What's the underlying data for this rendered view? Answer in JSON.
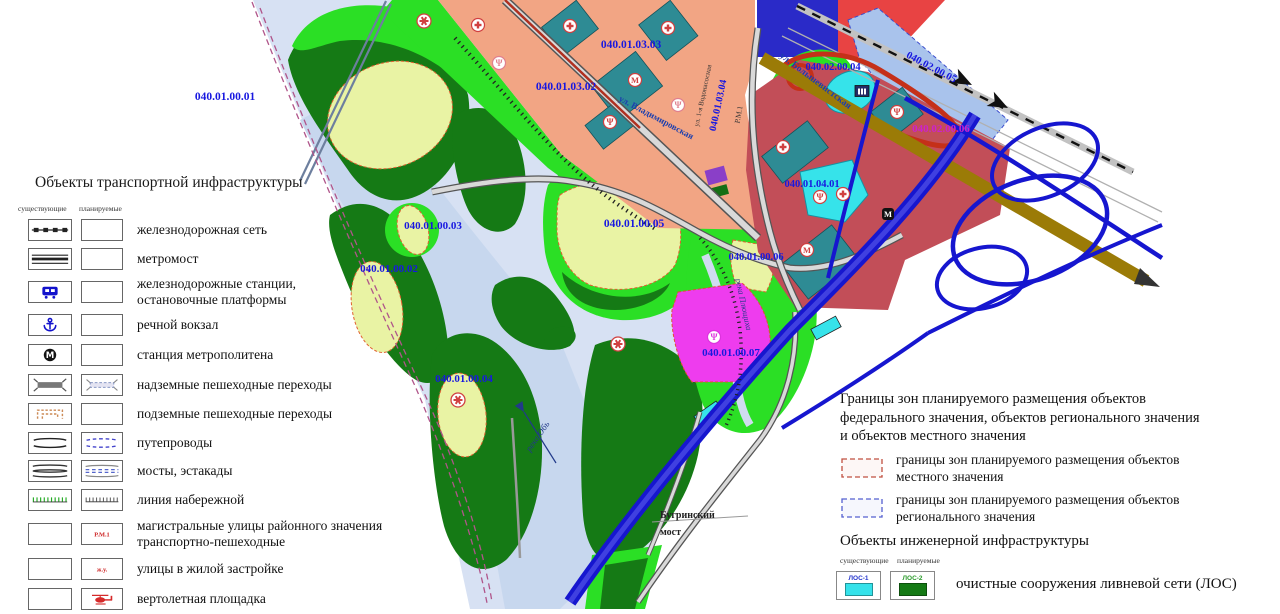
{
  "map": {
    "colors": {
      "wetland": "#d7e1f3",
      "river": "#c7d7ee",
      "forest": "#157a15",
      "greenbelt": "#2bdf25",
      "meadow": "#e9f3a4",
      "residential_salmon": "#f2a584",
      "zone_red": "#e84343",
      "zone_maroon": "#c24e58",
      "zone_blue_light": "#a9c3ec",
      "zone_indigo": "#2a2ac8",
      "zone_teal": "#2e8b94",
      "zone_cyan": "#36e3ea",
      "zone_magenta": "#ee3cee",
      "zone_pink": "#f0919e",
      "zone_purple": "#8a3fc8",
      "road_olive": "#9b7b07",
      "road_blue": "#1616cf",
      "road_red": "#c53019",
      "label_blue": "#1818e0",
      "label_magenta": "#cc22cc",
      "boundary_dash": "#b0558a"
    },
    "labels": [
      {
        "t": "040.01.00.01",
        "x": 225,
        "y": 100,
        "s": 11.5
      },
      {
        "t": "040.01.03.02",
        "x": 566,
        "y": 90,
        "s": 11.5
      },
      {
        "t": "040.01.03.03",
        "x": 631,
        "y": 48,
        "s": 11.5
      },
      {
        "t": "040.01.03.04",
        "x": 721,
        "y": 106,
        "r": -78,
        "s": 10
      },
      {
        "t": "ул. 1-я Водонасосная",
        "x": 705,
        "y": 96,
        "r": -78,
        "s": 7,
        "w": "normal",
        "c": "#333333"
      },
      {
        "t": "040.02.00.04",
        "x": 833,
        "y": 70,
        "s": 10.5
      },
      {
        "t": "040.02.00.05",
        "x": 930,
        "y": 70,
        "r": 28,
        "s": 10.5
      },
      {
        "t": "040.02.00.06",
        "x": 941,
        "y": 132,
        "s": 11,
        "c": "#cc22cc"
      },
      {
        "t": "040.01.04.01",
        "x": 812,
        "y": 187,
        "s": 10.5
      },
      {
        "t": "040.01.00.03",
        "x": 433,
        "y": 229,
        "s": 11
      },
      {
        "t": "040.01.00.05",
        "x": 634,
        "y": 227,
        "s": 11.5
      },
      {
        "t": "040.01.00.02",
        "x": 389,
        "y": 272,
        "s": 11
      },
      {
        "t": "040.01.00.06",
        "x": 756,
        "y": 260,
        "s": 10.5
      },
      {
        "t": "040.01.00.07",
        "x": 731,
        "y": 356,
        "s": 11
      },
      {
        "t": "040.01.00.04",
        "x": 464,
        "y": 382,
        "s": 11
      },
      {
        "t": "река Обь",
        "x": 540,
        "y": 438,
        "r": -55,
        "s": 9,
        "c": "#223a8a",
        "w": "normal",
        "i": true
      },
      {
        "t": "река Плющиха",
        "x": 741,
        "y": 305,
        "r": 78,
        "s": 8.5,
        "c": "#223a8a",
        "w": "normal",
        "i": true
      },
      {
        "t": "Бугринский",
        "x": 660,
        "y": 518,
        "s": 10,
        "c": "#222222",
        "a": "start"
      },
      {
        "t": "мост",
        "x": 660,
        "y": 535,
        "s": 10,
        "c": "#222222",
        "a": "start"
      },
      {
        "t": "ул. Владимировская",
        "x": 655,
        "y": 120,
        "r": 28,
        "s": 9,
        "c": "#1c3fae"
      },
      {
        "t": "ул. Большевистская",
        "x": 814,
        "y": 83,
        "r": 37,
        "s": 9.5,
        "c": "#1c3fae"
      },
      {
        "t": "Р.М.1",
        "x": 741,
        "y": 115,
        "r": -80,
        "s": 7.5,
        "w": "normal",
        "c": "#333333"
      }
    ],
    "icons": [
      {
        "type": "helipad-icon",
        "x": 424,
        "y": 21
      },
      {
        "type": "helipad-icon",
        "x": 458,
        "y": 400
      },
      {
        "type": "helipad-icon",
        "x": 618,
        "y": 344
      },
      {
        "type": "cross-icon",
        "x": 570,
        "y": 26,
        "c": "#d04040"
      },
      {
        "type": "cross-icon",
        "x": 478,
        "y": 25,
        "c": "#d04040"
      },
      {
        "type": "cross-icon",
        "x": 668,
        "y": 28,
        "c": "#d04040"
      },
      {
        "type": "cross-icon",
        "x": 783,
        "y": 147,
        "c": "#d04040"
      },
      {
        "type": "cross-icon",
        "x": 843,
        "y": 194,
        "c": "#d04040"
      },
      {
        "type": "metro-station-red-icon",
        "x": 635,
        "y": 80
      },
      {
        "type": "metro-station-red-icon",
        "x": 807,
        "y": 250
      },
      {
        "type": "trident-icon",
        "x": 610,
        "y": 122,
        "c": "#d04040"
      },
      {
        "type": "trident-icon",
        "x": 499,
        "y": 63,
        "c": "#e0808e"
      },
      {
        "type": "trident-icon",
        "x": 678,
        "y": 105,
        "c": "#e0808e"
      },
      {
        "type": "trident-icon",
        "x": 897,
        "y": 112,
        "c": "#d04040"
      },
      {
        "type": "trident-icon",
        "x": 820,
        "y": 197,
        "c": "#d04040"
      },
      {
        "type": "trident-icon",
        "x": 714,
        "y": 337,
        "c": "#dd33dd"
      },
      {
        "type": "metro-m-black-icon",
        "x": 888,
        "y": 214
      },
      {
        "type": "building-icon",
        "x": 862,
        "y": 91
      }
    ]
  },
  "legend_transport": {
    "title": "Объекты транспортной инфраструктуры",
    "col_existing": "существующие",
    "col_planned": "планируемые",
    "rows": [
      {
        "se": "railway-line-icon",
        "sp": "empty-box",
        "label": "железнодорожная сеть",
        "h": 28
      },
      {
        "se": "metro-bridge-icon",
        "sp": "empty-box",
        "label": "метромост",
        "h": 30
      },
      {
        "se": "train-icon",
        "sp": "empty-box",
        "label": "железнодорожные станции,\nостановочные платформы",
        "h": 36
      },
      {
        "se": "anchor-icon",
        "sp": "empty-box",
        "label": "речной вокзал",
        "h": 30
      },
      {
        "se": "metro-m-icon",
        "sp": "empty-box",
        "label": "станция метрополитена",
        "h": 30
      },
      {
        "se": "overpass-solid-icon",
        "sp": "overpass-dashed-icon",
        "label": "надземные пешеходные переходы",
        "h": 29
      },
      {
        "se": "underpass-icon",
        "sp": "empty-box",
        "label": "подземные пешеходные переходы",
        "h": 29
      },
      {
        "se": "viaduct-solid-icon",
        "sp": "viaduct-dashed-icon",
        "label": "путепроводы",
        "h": 29
      },
      {
        "se": "bridge-solid-icon",
        "sp": "bridge-dashed-icon",
        "label": "мосты, эстакады",
        "h": 28
      },
      {
        "se": "embankment-green-icon",
        "sp": "embankment-gray-icon",
        "label": "линия набережной",
        "h": 30
      },
      {
        "se": "empty-box",
        "sp": "road-class-text",
        "sp_text": "Р.М.1",
        "label": "магистральные улицы районного значения\nтранспортно-пешеходные",
        "h": 38
      },
      {
        "se": "empty-box",
        "sp": "road-class-text",
        "sp_text": "ж.у.",
        "label": "улицы в жилой застройке",
        "h": 31
      },
      {
        "se": "empty-box",
        "sp": "helicopter-icon",
        "label": "вертолетная площадка",
        "h": 30
      }
    ]
  },
  "legend_boundaries": {
    "title": "Границы зон планируемого размещения объектов\nфедерального значения, объектов регионального значения\nи объектов местного значения",
    "rows": [
      {
        "symbol": "zone-red-dashed-icon",
        "label": "границы зон планируемого размещения объектов\nместного значения"
      },
      {
        "symbol": "zone-blue-dashed-icon",
        "label": "границы зон планируемого размещения объектов\nрегионального значения"
      }
    ]
  },
  "legend_engineering": {
    "title": "Объекты инженерной инфраструктуры",
    "col_existing": "существующие",
    "col_planned": "планируемые",
    "rows": [
      {
        "se": "los-existing-icon",
        "se_text": "ЛОС-1",
        "se_text_color": "#2233cc",
        "se_fill": "#35e2ea",
        "sp": "los-planned-icon",
        "sp_text": "ЛОС-2",
        "sp_text_color": "#2a9a2a",
        "sp_fill": "#157a15",
        "label": "очистные сооружения ливневой сети  (ЛОС)"
      }
    ]
  }
}
